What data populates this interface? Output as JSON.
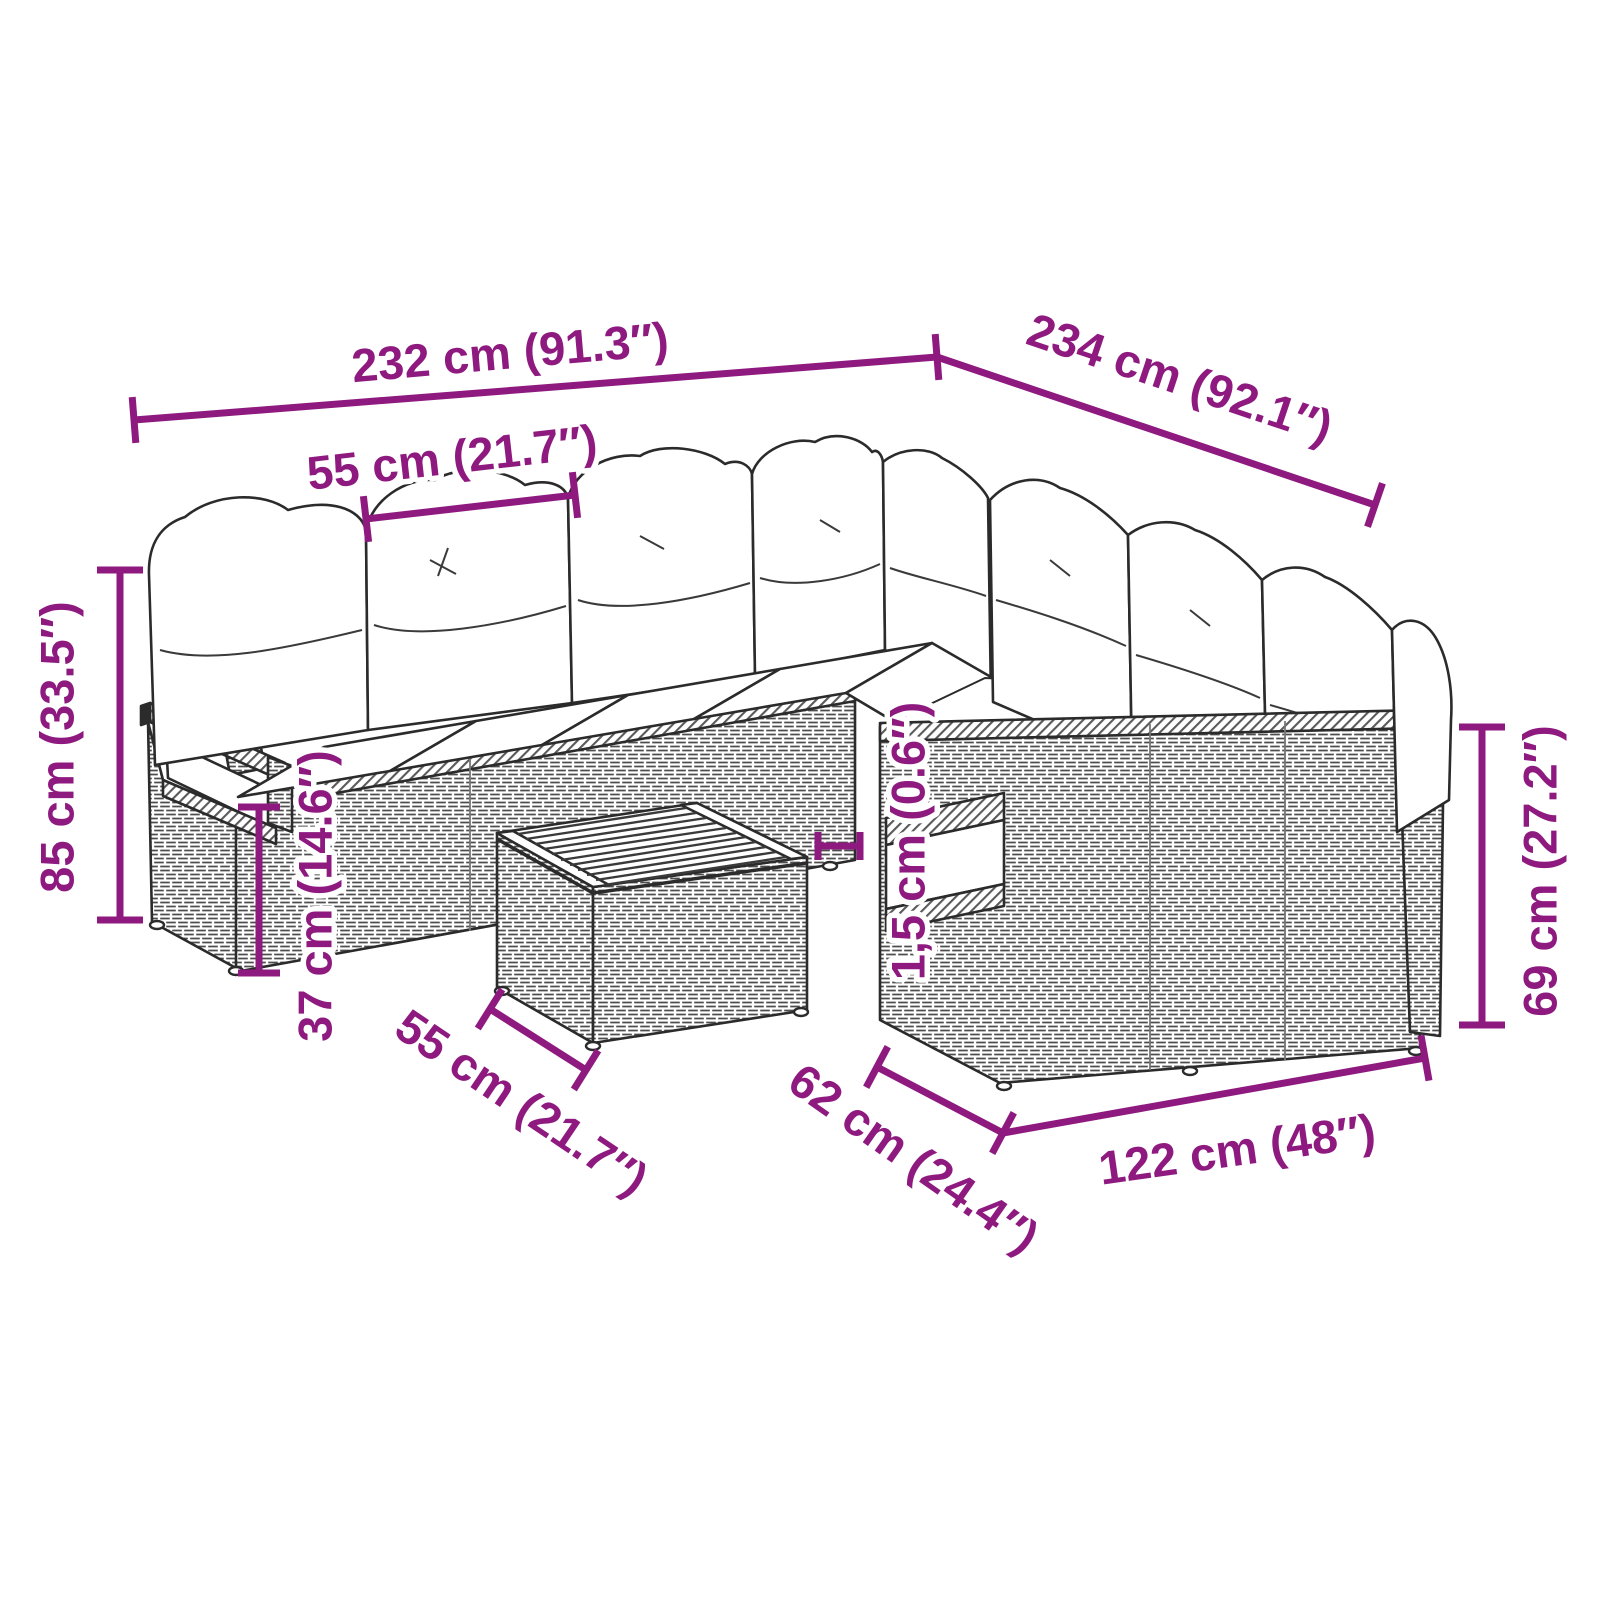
{
  "diagram": {
    "type": "product-dimension-diagram",
    "subject": "l-shaped-rattan-garden-sofa-set-with-cushions-and-table",
    "colors": {
      "accent": "#8e1a80",
      "line_art": "#2b2b2b",
      "background": "#ffffff"
    },
    "labels": {
      "total_width": "232 cm (91.3″)",
      "total_depth": "234 cm (92.1″)",
      "seat_width": "55 cm (21.7″)",
      "overall_height": "85 cm (33.5″)",
      "seat_height": "37 cm (14.6″)",
      "table_width": "55 cm (21.7″)",
      "cushion_thickness": "1,5 cm (0.6″)",
      "seat_depth": "62 cm (24.4″)",
      "right_sofa_width": "122 cm (48″)",
      "armrest_height": "69 cm (27.2″)"
    }
  }
}
